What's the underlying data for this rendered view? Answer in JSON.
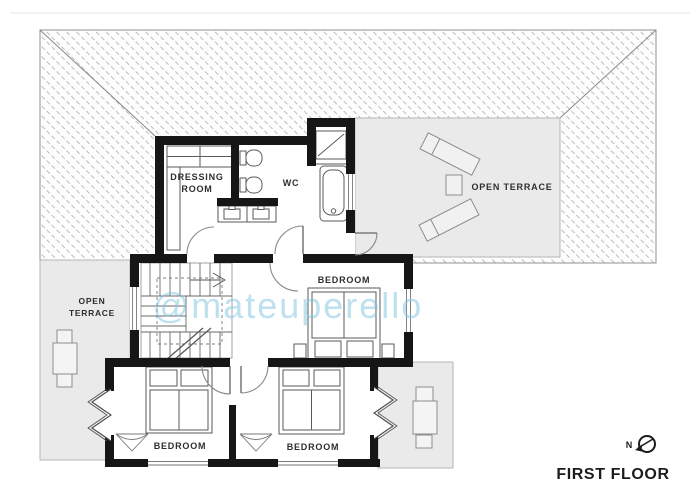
{
  "page": {
    "title_label": "FIRST FLOOR",
    "watermark": "@mateuperello",
    "compass_label": "N"
  },
  "rooms": {
    "dressing_room": {
      "label_line1": "DRESSING",
      "label_line2": "ROOM"
    },
    "wc": {
      "label": "WC"
    },
    "bedroom_center": {
      "label": "BEDROOM"
    },
    "bedroom_sw": {
      "label": "BEDROOM"
    },
    "bedroom_se": {
      "label": "BEDROOM"
    },
    "terrace_right": {
      "label": "OPEN TERRACE"
    },
    "terrace_left": {
      "label_line1": "OPEN",
      "label_line2": "TERRACE"
    }
  },
  "colors": {
    "wall": "#161616",
    "roof_hatch": "#a8a8a8",
    "roof_border": "#909090",
    "terrace_fill": "#eaeaea",
    "terrace_border": "#b5b5b5",
    "thin_line": "#555555",
    "door_arc": "#8a8a8a",
    "watermark": "#7ec3e0",
    "label": "#2e2e2e"
  }
}
